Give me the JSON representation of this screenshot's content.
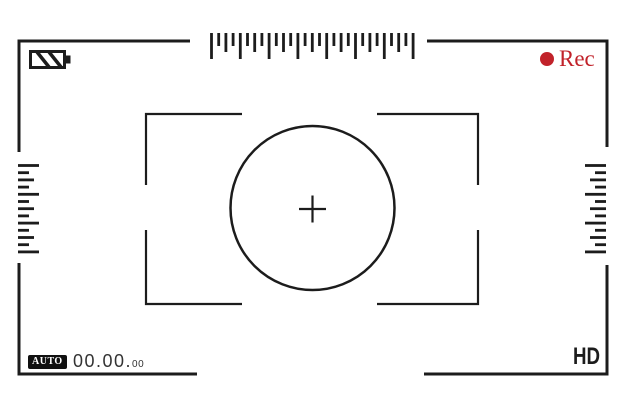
{
  "viewfinder": {
    "background": "#ffffff",
    "line_color": "#1c1c1c",
    "accent_red": "#c1222a"
  },
  "top_bar": {
    "battery_icon": "battery-icon",
    "rec_indicator": {
      "dot_icon": "record-dot-icon",
      "label": "Rec"
    }
  },
  "bottom_bar": {
    "mode_badge_label": "AUTO",
    "timecode": {
      "main": "00.00.",
      "sub": "00"
    },
    "quality_label": "HD"
  },
  "focus": {
    "icons": [
      "focus-bracket-icon",
      "focus-circle-icon",
      "crosshair-icon"
    ]
  },
  "rulers": {
    "top": {
      "ticks": 29
    },
    "left": {
      "ticks": 13
    },
    "right": {
      "ticks": 13
    }
  }
}
